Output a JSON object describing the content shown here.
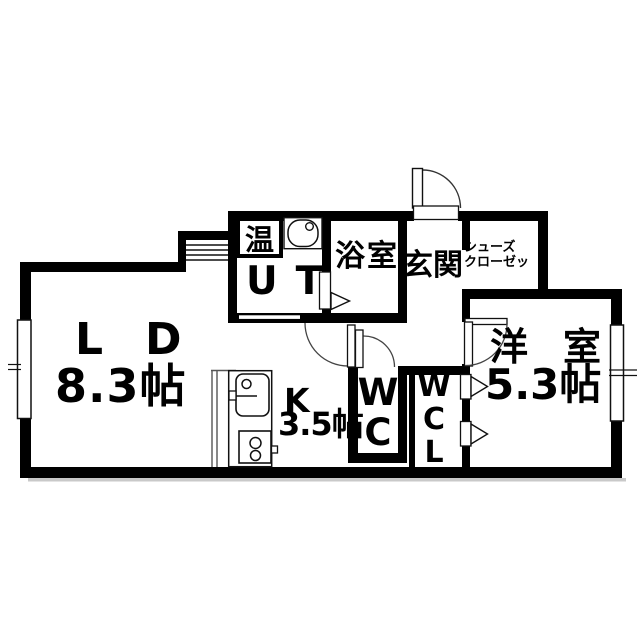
{
  "floorplan": {
    "type": "japanese-apartment-floorplan",
    "colors": {
      "wall": "#000000",
      "background": "#ffffff",
      "line": "#111111"
    },
    "rooms": {
      "living_dining": {
        "label": "LD",
        "size": "8.3帖"
      },
      "kitchen": {
        "label": "K",
        "size": "3.5帖"
      },
      "western_room": {
        "label": "洋室",
        "size": "5.3帖"
      },
      "bathroom": {
        "label": "浴室"
      },
      "entrance": {
        "label": "玄関"
      },
      "shoes_closet": {
        "line1": "シューズ",
        "line2": "クローゼッ"
      },
      "utility": {
        "label": "UT"
      },
      "water_heater": {
        "label": "温"
      },
      "toilet": {
        "letters": [
          "W",
          "C"
        ]
      },
      "walk_in_closet": {
        "letters": [
          "W",
          "C",
          "L"
        ]
      }
    }
  }
}
